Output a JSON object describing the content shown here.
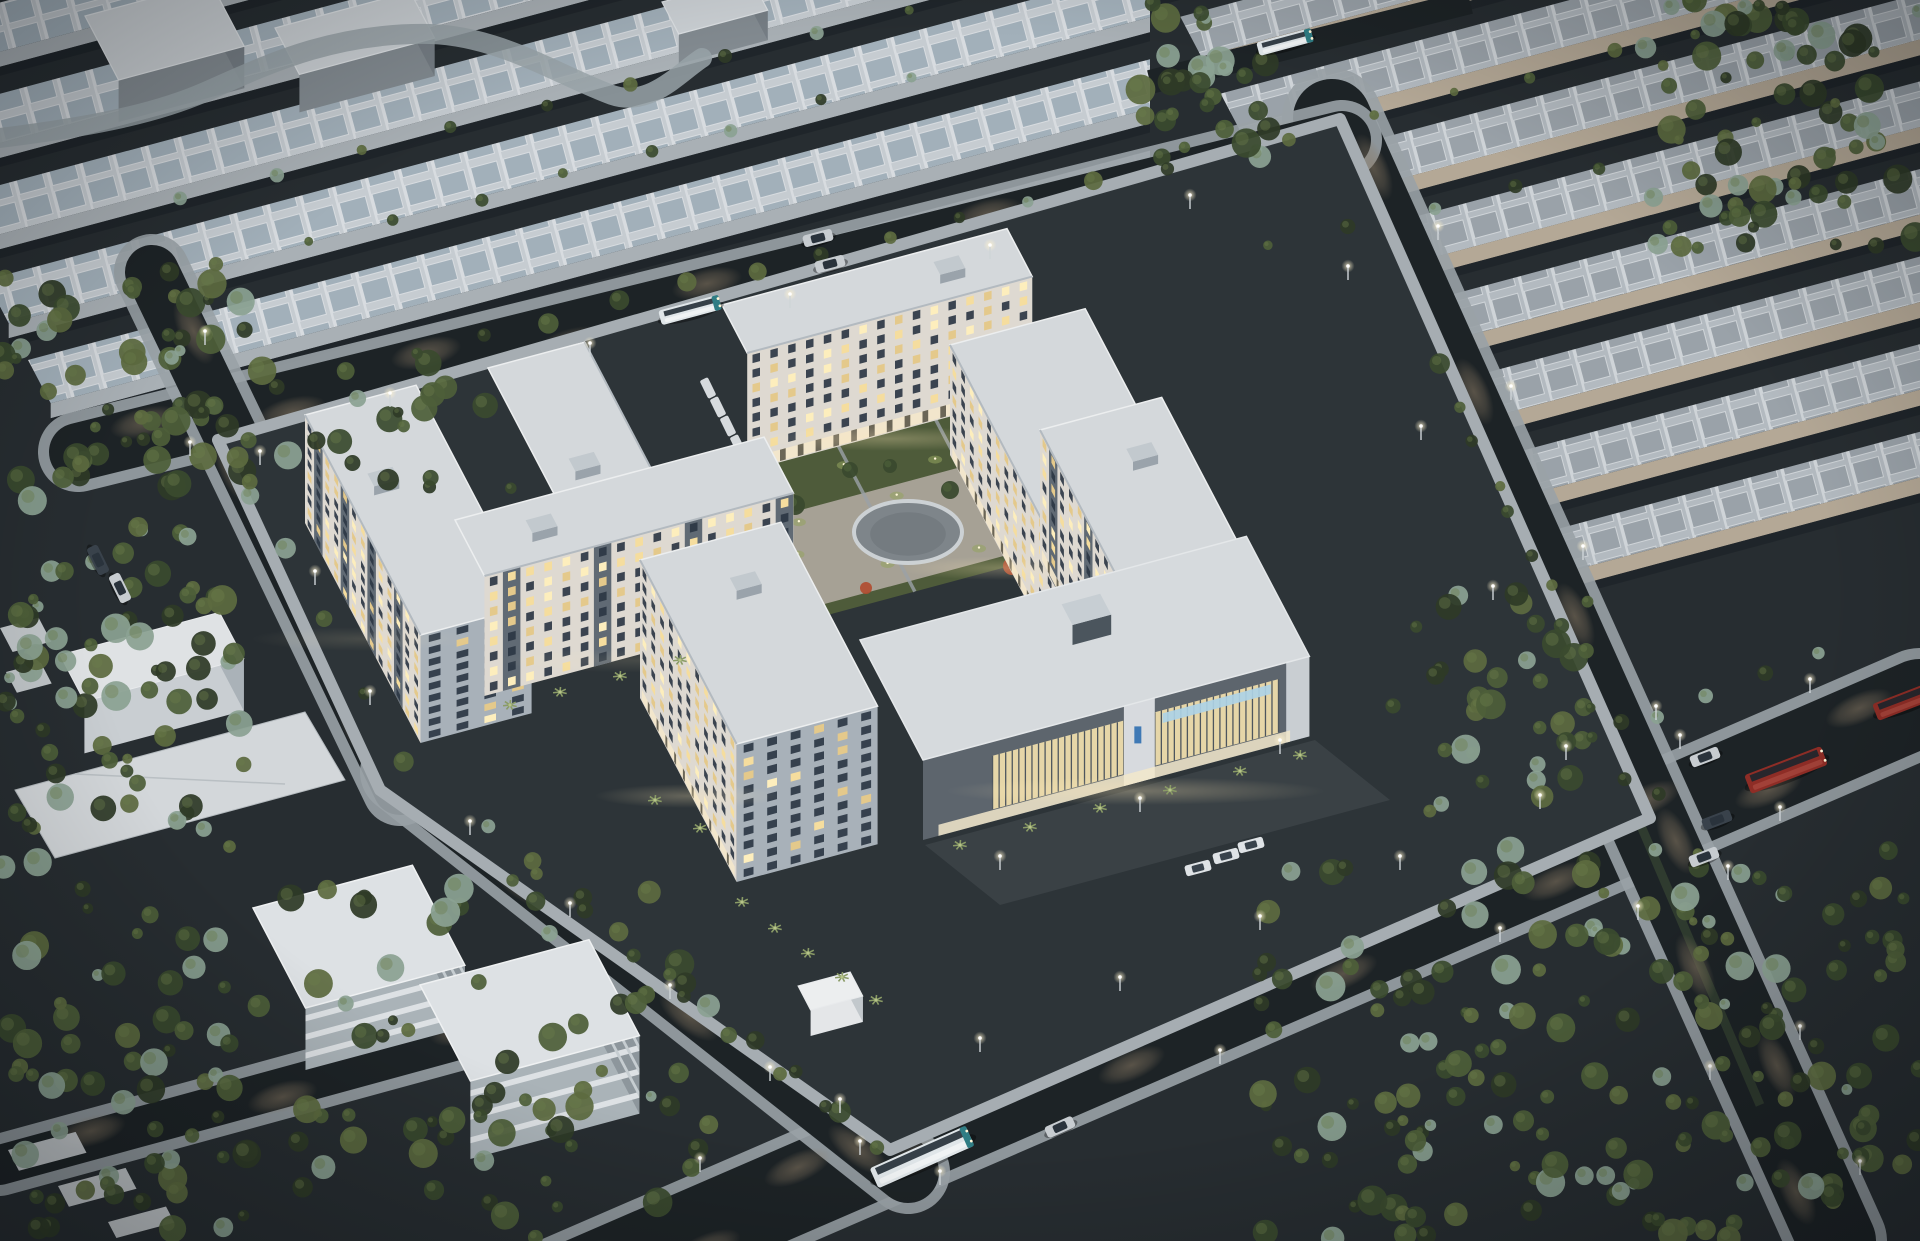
{
  "meta": {
    "kind": "architectural-aerial-dusk-render",
    "title": ""
  },
  "palette": {
    "ground": "#272d31",
    "groundComplex": "#2d3438",
    "asphalt": "#1d2326",
    "sidewalk": "#9aa2a7",
    "sidewalkBright": "#b6bcc0",
    "pool": "#8a7a64",
    "roofLight": "#d4d8db",
    "whRoofBg": "#c6ccd1",
    "whPanel": "#a2b0ba",
    "whWall": "#a9b0b5",
    "whWallShadow": "#838b91",
    "trWall": "#b4a896",
    "trPanel": "#9aa2a9",
    "trRoofBg": "#b3bac0",
    "facade": "#ded9d1",
    "facadeSide": "#a8b1b9",
    "facadeVr": "#d7d3cc",
    "accent": "#4e5a66",
    "windowDark": "#2c3744",
    "lit1": "#f5dd9e",
    "lit2": "#e4c98b",
    "lit3": "#fdeebd",
    "shop": "#f2e7cb",
    "lawn": "#4e5b3a",
    "lawnLit": "#94a45f",
    "paving": "#aba59a",
    "plazaIn": "#7e858a",
    "plazaRing": "#ccd1d4",
    "hedge": "#2b352a",
    "treeDark": "#2e3a27",
    "tree2": "#3a4a2e",
    "tree3": "#4d5f39",
    "treeOlive": "#5d6b3f",
    "treePale": "#8ba192",
    "orangeTree": "#b14c30",
    "palm": "#8a9b66",
    "lampGlow": "#fff3cf",
    "busRed": "#8e2d26",
    "busTeal": "#2f7d84",
    "busBody": "#e0e6e9",
    "carSilver": "#c7ccd0",
    "carDark": "#39424b",
    "cabin": "#2a333c",
    "logoBlue": "#3f79b5",
    "signBlue": "#aed2e6",
    "louver": "#e6d6a8",
    "garageDark": "#5d656d",
    "garageRoof": "#d6dadd",
    "canopy": "#d9dde0",
    "slabWhite": "#dde1e4",
    "slabShade": "#aab3b8",
    "white": "#e8eaec"
  },
  "scene": {
    "seed": 42,
    "viewport": {
      "w": 1920,
      "h": 1241
    },
    "basis": {
      "u": [
        0.966,
        -0.259
      ],
      "v": [
        0.42,
        0.8
      ]
    },
    "fields": [
      {
        "name": "warehouse-field-top-left",
        "o": [
          -140,
          40
        ],
        "rows": 8,
        "pitch": 100,
        "len": 1380,
        "dep": 54,
        "wallH": 15,
        "pattern": "whTL",
        "wall": "whWall",
        "clip": [
          [
            0,
            0
          ],
          [
            1150,
            0
          ],
          [
            1150,
            160
          ],
          [
            700,
            300
          ],
          [
            120,
            452
          ],
          [
            0,
            478
          ]
        ]
      },
      {
        "name": "warehouse-field-top-right",
        "o": [
          1140,
          -60
        ],
        "rows": 9,
        "pitch": 96,
        "len": 880,
        "dep": 50,
        "wallH": 16,
        "pattern": "whTR",
        "wall": "trWall",
        "clip": [
          [
            1150,
            0
          ],
          [
            1920,
            0
          ],
          [
            1920,
            700
          ],
          [
            1660,
            825
          ],
          [
            1335,
            130
          ],
          [
            1150,
            185
          ]
        ]
      }
    ],
    "villas": [
      {
        "o": [
          85,
          16
        ],
        "lu": 130,
        "lv": 80,
        "h": 42
      },
      {
        "o": [
          275,
          28
        ],
        "lu": 140,
        "lv": 58,
        "h": 38
      },
      {
        "o": [
          662,
          2
        ],
        "lu": 92,
        "lv": 40,
        "h": 30
      }
    ],
    "curvedPath": "M0,138 C80,128 150,116 205,92 C260,68 330,32 430,34 C500,36 560,76 612,95 C650,108 680,72 702,58",
    "topGapRoad": {
      "p1": [
        1150,
        82
      ],
      "p2": [
        1470,
        2
      ],
      "w": 24
    },
    "roads": [
      {
        "id": "road-bottom",
        "p1": [
          540,
          1300
        ],
        "p2": [
          1920,
          703
        ],
        "w": 88,
        "pools": 13
      },
      {
        "id": "road-right",
        "p1": [
          1332,
          118
        ],
        "p2": [
          1837,
          1241
        ],
        "w": 78,
        "pools": 10,
        "median": true
      },
      {
        "id": "road-top",
        "p1": [
          78,
          452
        ],
        "p2": [
          1342,
          140
        ],
        "w": 58,
        "pools": 9
      },
      {
        "id": "road-left",
        "p1": [
          152,
          272
        ],
        "p2": [
          400,
          788
        ],
        "w": 54,
        "pools": 4
      },
      {
        "id": "road-southwest",
        "p1": [
          402,
          772
        ],
        "p2": [
          908,
          1172
        ],
        "w": 62,
        "pools": 6
      },
      {
        "id": "road-corner-bl",
        "p1": [
          0,
          1165
        ],
        "p2": [
          560,
          1012
        ],
        "w": 40,
        "pools": 3
      }
    ],
    "ringPolygon": [
      [
        218,
        440
      ],
      [
        1340,
        119
      ],
      [
        1650,
        818
      ],
      [
        890,
        1150
      ],
      [
        380,
        790
      ]
    ],
    "courtyard": {
      "o": [
        650,
        480
      ],
      "au": 360,
      "bv": 200,
      "paving": {
        "o": [
          670,
          545
        ],
        "au": 350,
        "bv": 110
      },
      "plaza": {
        "cx": 908,
        "cy": 532,
        "rx": 54,
        "ry": 31
      },
      "lawnLights": 26,
      "greenTrees": [
        [
          700,
          520,
          9
        ],
        [
          745,
          480,
          8
        ],
        [
          795,
          505,
          10
        ],
        [
          850,
          470,
          8
        ],
        [
          950,
          490,
          9
        ],
        [
          1000,
          520,
          8
        ],
        [
          1040,
          560,
          9
        ],
        [
          762,
          612,
          8
        ],
        [
          832,
          642,
          9
        ],
        [
          890,
          466,
          7
        ]
      ],
      "orangeTrees": [
        [
          772,
          562,
          8
        ],
        [
          1012,
          566,
          9
        ],
        [
          1080,
          592,
          7
        ],
        [
          866,
          588,
          6
        ],
        [
          918,
          645,
          7
        ]
      ],
      "parkedCars": {
        "base": [
          708,
          388
        ],
        "step": [
          10,
          19
        ],
        "count": 4
      }
    },
    "apartments": [
      {
        "name": "apartment-top-slab",
        "o": [
          722,
          305
        ],
        "lu": 295,
        "lv": 60,
        "h": 118,
        "or": "u",
        "fl": 8,
        "shops": true,
        "roofBox": [
          0.72,
          0.25
        ],
        "accent": 0,
        "seed": 11
      },
      {
        "name": "apartment-upper-left",
        "o": [
          488,
          368
        ],
        "lu": 100,
        "lv": 205,
        "h": 105,
        "or": "vr",
        "fl": 8,
        "shops": true,
        "roofBox": [
          0.3,
          0.6
        ],
        "accent": 0,
        "seed": 7
      },
      {
        "name": "apartment-west-slab",
        "o": [
          305,
          415
        ],
        "lu": 115,
        "lv": 275,
        "h": 108,
        "or": "v",
        "fl": 9,
        "shops": false,
        "roofBox": [
          0.25,
          0.3
        ],
        "accent": 3,
        "seed": 3
      },
      {
        "name": "apartment-east-upper",
        "o": [
          950,
          345
        ],
        "lu": 140,
        "lv": 268,
        "h": 110,
        "or": "v",
        "fl": 8,
        "shops": true,
        "roofBox": [
          0.3,
          0.5
        ],
        "accent": 0,
        "seed": 5
      },
      {
        "name": "apartment-east-tower",
        "o": [
          1040,
          430
        ],
        "lu": 126,
        "lv": 230,
        "h": 128,
        "or": "v",
        "fl": 9,
        "shops": true,
        "roofBox": [
          0.55,
          0.2
        ],
        "accent": 4,
        "seed": 9
      },
      {
        "name": "apartment-southwest",
        "o": [
          455,
          520
        ],
        "lu": 320,
        "lv": 70,
        "h": 120,
        "or": "u",
        "fl": 8,
        "shops": false,
        "roofBox": [
          0.2,
          0.3
        ],
        "accent": 5,
        "seed": 13
      },
      {
        "name": "apartment-south-tower",
        "o": [
          640,
          560
        ],
        "lu": 146,
        "lv": 230,
        "h": 138,
        "or": "v",
        "fl": 10,
        "shops": true,
        "roofBox": [
          0.5,
          0.2
        ],
        "accent": 0,
        "seed": 17
      }
    ],
    "garage": {
      "o": [
        860,
        640
      ],
      "lu": 400,
      "lv": 150,
      "h": 80,
      "bands": [
        [
          0.18,
          0.52
        ],
        [
          0.6,
          0.92
        ]
      ],
      "sign": [
        0.62,
        0.9
      ],
      "logoT": 0.556
    },
    "gatehouse": {
      "o": [
        798,
        986
      ],
      "lu": 54,
      "lv": 30,
      "h": 26
    },
    "auxWhiteBox": {
      "o": [
        60,
        655
      ],
      "lu": 165,
      "lv": 58,
      "h": 52
    },
    "canopy": [
      [
        15,
        790
      ],
      [
        305,
        712
      ],
      [
        345,
        780
      ],
      [
        55,
        858
      ]
    ],
    "slabs": [
      {
        "o": [
          253,
          908
        ],
        "lu": 165,
        "lv": 125,
        "h": 62
      },
      {
        "o": [
          420,
          985
        ],
        "lu": 175,
        "lv": 120,
        "h": 78
      }
    ],
    "flatRoofBits": [
      [
        8,
        1150,
        70,
        26
      ],
      [
        58,
        1186,
        70,
        26
      ],
      [
        108,
        1222,
        60,
        20
      ],
      [
        0,
        628,
        40,
        30
      ],
      [
        6,
        672,
        36,
        26
      ]
    ],
    "forests": [
      {
        "rect": [
          1255,
          845,
          665,
          396
        ],
        "n": 170
      },
      {
        "rect": [
          0,
          270,
          245,
          580
        ],
        "n": 120
      },
      {
        "rect": [
          1640,
          0,
          280,
          250
        ],
        "n": 70
      },
      {
        "rect": [
          240,
          880,
          470,
          360
        ],
        "n": 70
      },
      {
        "rect": [
          1130,
          0,
          140,
          160
        ],
        "n": 30
      },
      {
        "rect": [
          60,
          360,
          460,
          140
        ],
        "n": 26
      },
      {
        "rect": [
          1380,
          560,
          230,
          250
        ],
        "n": 32
      },
      {
        "rect": [
          0,
          860,
          240,
          380
        ],
        "n": 60
      }
    ],
    "treeRows": [
      {
        "from": [
          110,
          430
        ],
        "to": [
          1200,
          157
        ],
        "n": 16,
        "r": 8
      },
      {
        "from": [
          1420,
          330
        ],
        "to": [
          1860,
          1190
        ],
        "n": 12,
        "r": 8
      },
      {
        "from": [
          1448,
          372
        ],
        "to": [
          1770,
          1110
        ],
        "n": 10,
        "r": 6
      },
      {
        "from": [
          1400,
          820
        ],
        "to": [
          1850,
          640
        ],
        "n": 8,
        "r": 7
      },
      {
        "from": [
          150,
          300
        ],
        "to": [
          420,
          800
        ],
        "n": 7,
        "r": 8
      },
      {
        "from": [
          470,
          812
        ],
        "to": [
          862,
          1128
        ],
        "n": 9,
        "r": 9
      },
      {
        "from": [
          510,
          855
        ],
        "to": [
          900,
          1168
        ],
        "n": 8,
        "r": 8
      },
      {
        "from": [
          140,
          215
        ],
        "to": [
          1040,
          -26
        ],
        "n": 10,
        "r": 6
      },
      {
        "from": [
          90,
          300
        ],
        "to": [
          950,
          70
        ],
        "n": 10,
        "r": 6
      },
      {
        "from": [
          1250,
          150
        ],
        "to": [
          1900,
          -20
        ],
        "n": 8,
        "r": 6
      },
      {
        "from": [
          1230,
          260
        ],
        "to": [
          1880,
          90
        ],
        "n": 8,
        "r": 6
      }
    ],
    "palms": [
      [
        742,
        902
      ],
      [
        775,
        928
      ],
      [
        808,
        953
      ],
      [
        842,
        977
      ],
      [
        876,
        1000
      ],
      [
        960,
        845
      ],
      [
        1030,
        827
      ],
      [
        1100,
        808
      ],
      [
        1170,
        790
      ],
      [
        1240,
        771
      ],
      [
        1300,
        755
      ],
      [
        510,
        705
      ],
      [
        560,
        692
      ],
      [
        620,
        676
      ],
      [
        680,
        660
      ],
      [
        700,
        828
      ],
      [
        655,
        800
      ]
    ],
    "vehicles": {
      "buses": [
        {
          "x": 690,
          "y": 310,
          "a": -15,
          "len": 62,
          "w": 15,
          "style": "teal"
        },
        {
          "x": 1285,
          "y": 42,
          "a": -15,
          "len": 56,
          "w": 14,
          "style": "teal"
        },
        {
          "x": 922,
          "y": 1157,
          "a": -24,
          "len": 105,
          "w": 22,
          "style": "white"
        },
        {
          "x": 1786,
          "y": 770,
          "a": -21,
          "len": 82,
          "w": 20,
          "style": "red"
        },
        {
          "x": 1908,
          "y": 700,
          "a": -21,
          "len": 70,
          "w": 18,
          "style": "red"
        }
      ],
      "cars": [
        {
          "x": 818,
          "y": 238,
          "a": -15,
          "c": "carSilver"
        },
        {
          "x": 830,
          "y": 264,
          "a": -15,
          "c": "carSilver"
        },
        {
          "x": 1060,
          "y": 1127,
          "a": -24,
          "c": "carSilver"
        },
        {
          "x": 1705,
          "y": 757,
          "a": -21,
          "c": "carSilver"
        },
        {
          "x": 1717,
          "y": 820,
          "a": -21,
          "c": "carDark"
        },
        {
          "x": 1704,
          "y": 857,
          "a": -21,
          "c": "carSilver"
        },
        {
          "x": 98,
          "y": 560,
          "a": 64,
          "c": "carDark"
        },
        {
          "x": 120,
          "y": 588,
          "a": 64,
          "c": "carSilver"
        }
      ],
      "vans": [
        {
          "x": 1198,
          "y": 868,
          "a": -15
        },
        {
          "x": 1226,
          "y": 856,
          "a": -15
        },
        {
          "x": 1251,
          "y": 845,
          "a": -15
        }
      ]
    },
    "lamps": [
      [
        700,
        1172
      ],
      [
        840,
        1113
      ],
      [
        980,
        1052
      ],
      [
        1120,
        991
      ],
      [
        1260,
        930
      ],
      [
        1400,
        870
      ],
      [
        1540,
        809
      ],
      [
        1680,
        749
      ],
      [
        1810,
        693
      ],
      [
        940,
        1185
      ],
      [
        1220,
        1064
      ],
      [
        1500,
        942
      ],
      [
        1780,
        821
      ],
      [
        1348,
        280
      ],
      [
        1421,
        440
      ],
      [
        1493,
        600
      ],
      [
        1566,
        760
      ],
      [
        1638,
        920
      ],
      [
        1710,
        1080
      ],
      [
        1438,
        240
      ],
      [
        1511,
        400
      ],
      [
        1583,
        560
      ],
      [
        1656,
        720
      ],
      [
        1728,
        880
      ],
      [
        1800,
        1040
      ],
      [
        1860,
        1175
      ],
      [
        190,
        456
      ],
      [
        390,
        407
      ],
      [
        590,
        357
      ],
      [
        790,
        308
      ],
      [
        990,
        259
      ],
      [
        1190,
        209
      ],
      [
        205,
        345
      ],
      [
        260,
        465
      ],
      [
        315,
        585
      ],
      [
        370,
        705
      ],
      [
        470,
        835
      ],
      [
        570,
        917
      ],
      [
        670,
        999
      ],
      [
        770,
        1081
      ],
      [
        860,
        1155
      ],
      [
        1000,
        870
      ],
      [
        1140,
        812
      ],
      [
        1280,
        754
      ]
    ]
  }
}
